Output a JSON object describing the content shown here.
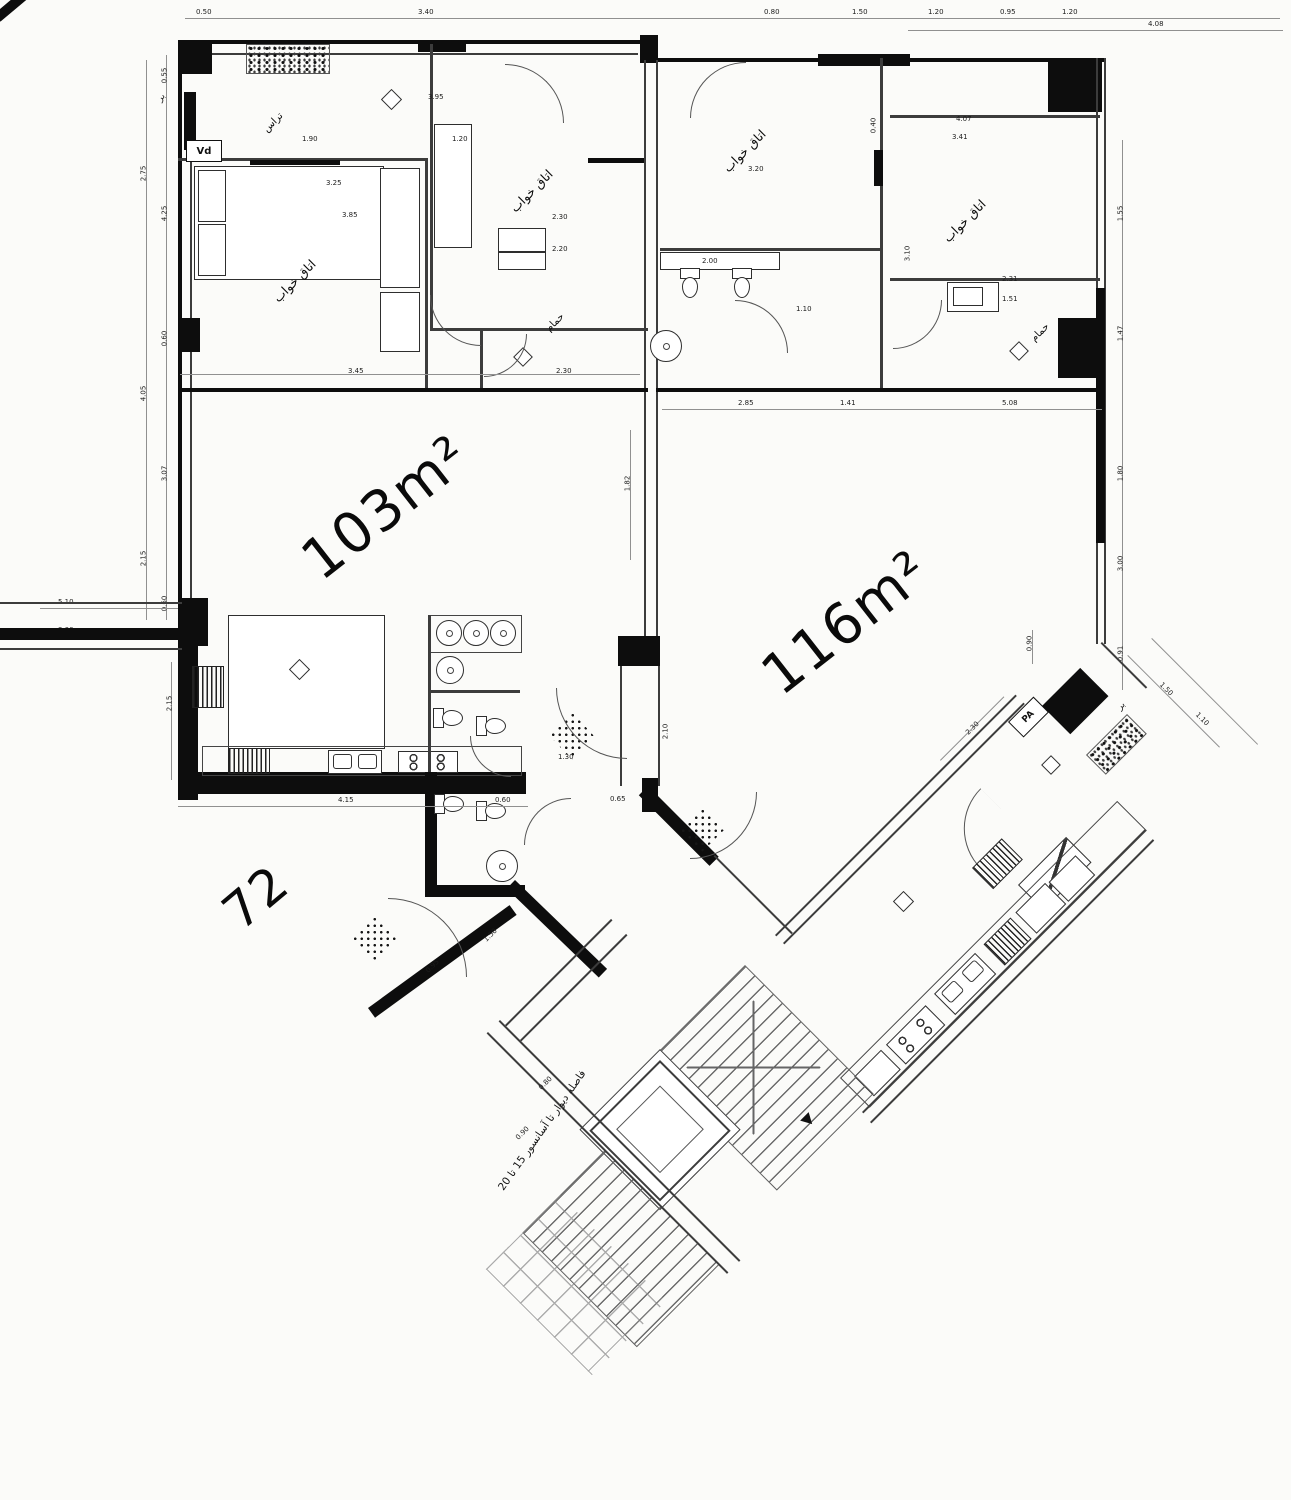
{
  "areas": {
    "left": "103m²",
    "right": "116m²",
    "partial": "72"
  },
  "labels": {
    "bedroom": "اتاق خواب",
    "bathroom": "حمام",
    "terrace": "تراس"
  },
  "tags": {
    "vd": "Vd",
    "pa": "PA",
    "edge_top": "بر",
    "edge_wing": "بر"
  },
  "note": "فاصله دیوار تا آسانسور 15 تا 20",
  "dims": {
    "top": [
      "0.50",
      "3.40",
      "0.80",
      "1.50",
      "1.20",
      "0.95",
      "1.20",
      "4.08"
    ],
    "left_outer": [
      "2.75",
      "4.05",
      "2.15"
    ],
    "left_inner": [
      "0.55",
      "4.25",
      "0.60",
      "3.07",
      "0.60"
    ],
    "left_low": [
      "5.10",
      "3.00",
      "2.15"
    ],
    "right": [
      "1.55",
      "1.47",
      "1.80",
      "3.00",
      "0.91"
    ],
    "inner": [
      "3.95",
      "1.90",
      "1.20",
      "3.25",
      "3.85",
      "2.30",
      "2.20",
      "3.20",
      "4.07",
      "3.41",
      "0.40",
      "2.00",
      "1.10",
      "2.85",
      "1.41",
      "5.08",
      "3.45",
      "2.30",
      "1.82",
      "4.15",
      "0.60",
      "1.30",
      "0.65",
      "2.10",
      "3.10",
      "2.31",
      "1.51"
    ],
    "wing": [
      "2.30",
      "0.90",
      "1.50",
      "1.10"
    ],
    "stairs": [
      "0.80",
      "0.90",
      "1.50",
      "0.95"
    ]
  }
}
